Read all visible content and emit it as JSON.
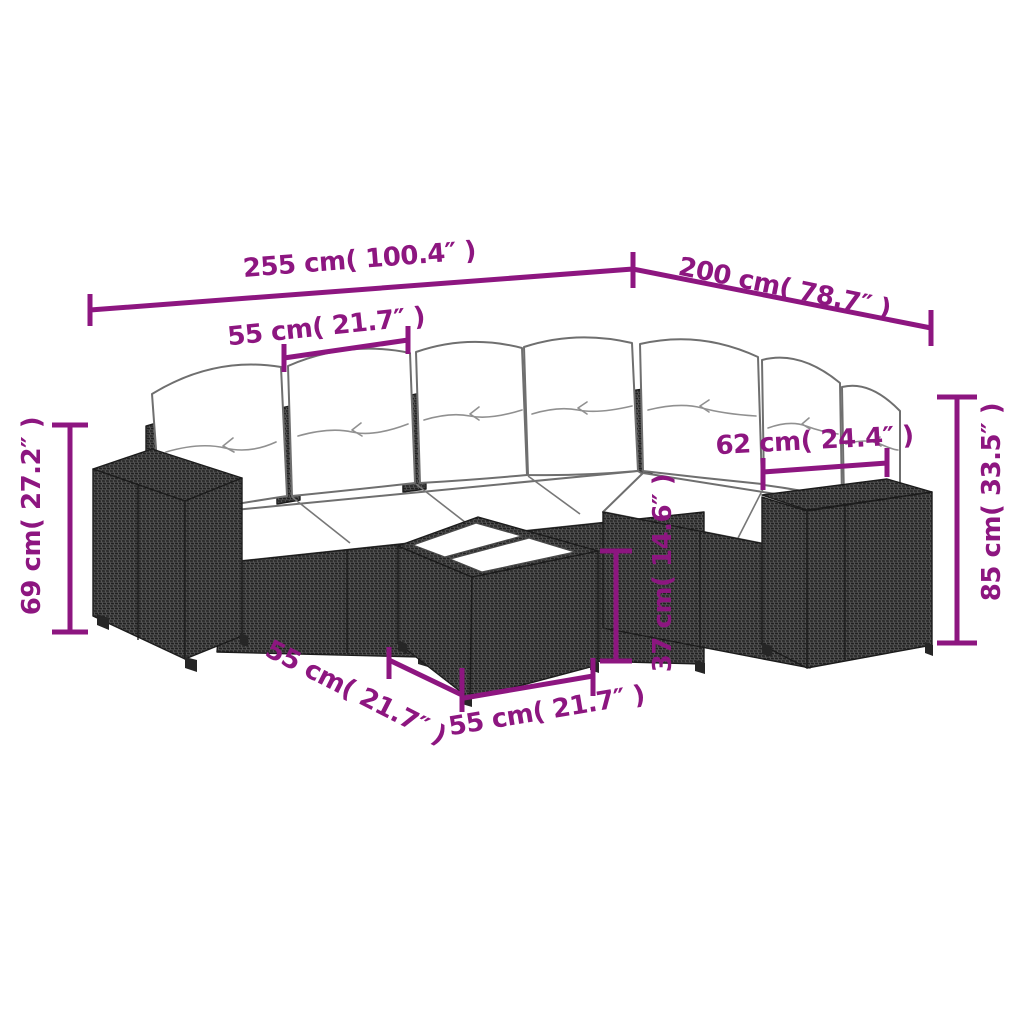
{
  "page": {
    "type": "product-dimension-diagram",
    "background": "#ffffff",
    "subject": "7-piece poly rattan corner sofa set with white cushions and glass-top coffee table",
    "back_cushion_count": 7,
    "table_count": 1
  },
  "colors": {
    "dimension_accent": "#8d1680",
    "rattan_dark": "#3f3f3f",
    "rattan_weave_light": "#5e5e5e",
    "rattan_weave_shadow": "#1f1f1f",
    "cushion_white": "#ffffff",
    "outline_gray": "#6f6f6f"
  },
  "dimensions": {
    "overall_width": {
      "label": "255 cm( 100.4″ )"
    },
    "overall_depth": {
      "label": "200 cm( 78.7″ )"
    },
    "seat_width": {
      "label": "55 cm( 21.7″ )"
    },
    "side_section_width": {
      "label": "62 cm( 24.4″ )"
    },
    "seat_height": {
      "label": "69 cm( 27.2″ )"
    },
    "total_height": {
      "label": "85 cm( 33.5″ )"
    },
    "table_height": {
      "label": "37 cm( 14.6″ )"
    },
    "table_depth": {
      "label": "55 cm( 21.7″ )"
    },
    "table_width": {
      "label": "55 cm( 21.7″ )"
    }
  }
}
